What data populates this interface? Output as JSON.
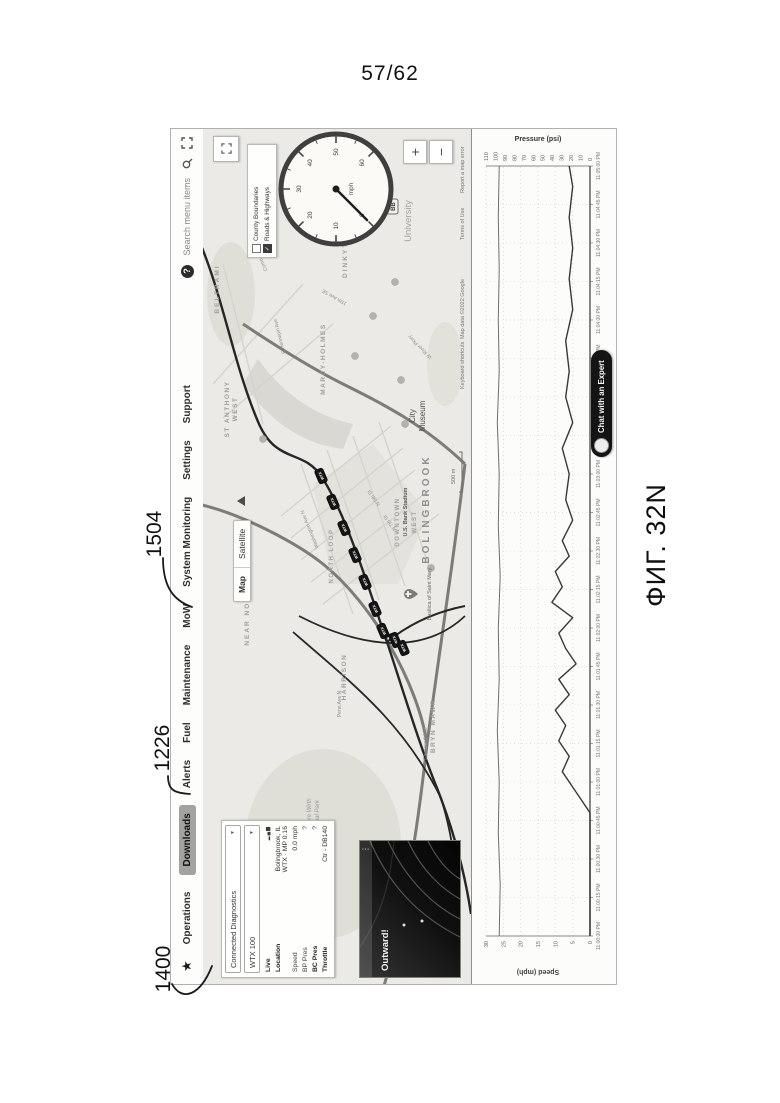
{
  "page": {
    "sheet_number": "57/62",
    "figure_label": "ФИГ. 32N",
    "refs": [
      {
        "id": "1400"
      },
      {
        "id": "1226"
      },
      {
        "id": "1504"
      }
    ]
  },
  "nav": {
    "star_icon": "★",
    "items": [
      {
        "label": "Operations",
        "active": false
      },
      {
        "label": "Downloads",
        "active": true
      },
      {
        "label": "Alerts",
        "active": false
      },
      {
        "label": "Fuel",
        "active": false
      },
      {
        "label": "Maintenance",
        "active": false
      },
      {
        "label": "MoW",
        "active": false
      },
      {
        "label": "System Monitoring",
        "active": false
      },
      {
        "label": "Settings",
        "active": false
      },
      {
        "label": "Support",
        "active": false
      }
    ],
    "help_label": "?",
    "search_placeholder": "Search menu items"
  },
  "sidebar": {
    "fleet_select": "Connected Diagnostics",
    "unit_select": "WTX 100",
    "live_label": "Live",
    "location_label": "Location",
    "location_value_line1": "Bolingbrook, IL",
    "location_value_line2": "WTX · MP 0.16",
    "rows": [
      {
        "label": "Speed",
        "value": "0.0 mph",
        "bold": false
      },
      {
        "label": "BP Pres",
        "value": "?",
        "bold": false
      },
      {
        "label": "BC Pres",
        "value": "?",
        "bold": true
      },
      {
        "label": "Throttle",
        "value": "Ctr - DB140",
        "bold": true
      }
    ]
  },
  "video": {
    "title": "Outward!",
    "menu_icon": "⋮"
  },
  "map": {
    "toggle": {
      "map_label": "Map",
      "satellite_label": "Satellite"
    },
    "layers": [
      {
        "label": "County Boundaries",
        "checked": false
      },
      {
        "label": "Roads & Highways",
        "checked": true
      }
    ],
    "gauge": {
      "unit": "mph",
      "tick_labels": [
        "0",
        "10",
        "20",
        "30",
        "40",
        "50",
        "60"
      ],
      "value_mph": 0
    },
    "controls": {
      "zoom_in": "+",
      "zoom_out": "−"
    },
    "scale_label": "500 m",
    "bb_label": "BB",
    "attribution": [
      {
        "text": "Keyboard shortcuts",
        "x": 595
      },
      {
        "text": "Map data ©2022 Google",
        "x": 645
      },
      {
        "text": "Terms of Use",
        "x": 744
      },
      {
        "text": "Report a map error",
        "x": 791
      }
    ],
    "place_labels": [
      {
        "lines": [
          "BELTRAMI"
        ],
        "x": 695,
        "y": 16,
        "s": 6.5,
        "ls": 2,
        "c": "#9e9e9e",
        "w": 600
      },
      {
        "lines": [
          "ST ANTHONY",
          "WEST"
        ],
        "x": 575,
        "y": 26,
        "s": 6.5,
        "ls": 1.5,
        "c": "#9e9e9e",
        "w": 600,
        "lh": 8
      },
      {
        "lines": [
          "NEAR NORTH"
        ],
        "x": 370,
        "y": 46,
        "s": 6.5,
        "ls": 2,
        "c": "#9e9e9e",
        "w": 600
      },
      {
        "lines": [
          "MARCY-HOLMES"
        ],
        "x": 625,
        "y": 122,
        "s": 6.5,
        "ls": 1.5,
        "c": "#9e9e9e",
        "w": 600
      },
      {
        "lines": [
          "DINKYTOWN"
        ],
        "x": 735,
        "y": 144,
        "s": 6.5,
        "ls": 2,
        "c": "#9e9e9e",
        "w": 600
      },
      {
        "lines": [
          "NORTH LOOP"
        ],
        "x": 428,
        "y": 130,
        "s": 6,
        "ls": 1.5,
        "c": "#a2a2a2",
        "w": 600
      },
      {
        "lines": [
          "HARRISON"
        ],
        "x": 307,
        "y": 143,
        "s": 6.5,
        "ls": 1.5,
        "c": "#9e9e9e",
        "w": 600
      },
      {
        "lines": [
          "BRYN MAWR"
        ],
        "x": 258,
        "y": 232,
        "s": 6.5,
        "ls": 1.5,
        "c": "#9e9e9e",
        "w": 600
      },
      {
        "lines": [
          "DOWNTOWN"
        ],
        "x": 462,
        "y": 196,
        "s": 6,
        "ls": 1.5,
        "c": "#a0a0a0",
        "w": 600
      },
      {
        "lines": [
          "U.S. Bank Stadium"
        ],
        "x": 472,
        "y": 204,
        "s": 5.5,
        "c": "#5a5a5a",
        "w": 600
      },
      {
        "lines": [
          "WEST"
        ],
        "x": 462,
        "y": 213,
        "s": 6,
        "ls": 1.5,
        "c": "#a0a0a0",
        "w": 600
      },
      {
        "lines": [
          "BOLINGBROOK"
        ],
        "x": 475,
        "y": 226,
        "s": 10,
        "ls": 3,
        "c": "#8f8f8f",
        "w": 700
      },
      {
        "lines": [
          "City",
          "Museum"
        ],
        "x": 568,
        "y": 212,
        "s": 8,
        "c": "#4c4c4c",
        "w": 400,
        "lh": 10
      },
      {
        "lines": [
          "Basilica of Saint Mary"
        ],
        "x": 390,
        "y": 228,
        "s": 5.5,
        "c": "#6a6a6a",
        "w": 400
      },
      {
        "lines": [
          "University"
        ],
        "x": 763,
        "y": 208,
        "s": 9.5,
        "c": "#a3a3a3",
        "w": 400
      },
      {
        "lines": [
          "Theodore Wirth",
          "Regional Park"
        ],
        "x": 165,
        "y": 108,
        "s": 6,
        "c": "#9a9a9a",
        "w": 400,
        "italic": true,
        "lh": 8
      },
      {
        "lines": [
          "Washington Ave N"
        ],
        "x": 455,
        "y": 108,
        "s": 5,
        "c": "#8d8d8d",
        "rot": -22
      },
      {
        "lines": [
          "N 5th St"
        ],
        "x": 487,
        "y": 172,
        "s": 5,
        "c": "#8d8d8d",
        "rot": -35
      },
      {
        "lines": [
          "N 7th St"
        ],
        "x": 462,
        "y": 188,
        "s": 5,
        "c": "#8d8d8d",
        "rot": -35
      },
      {
        "lines": [
          "Penn Ave N"
        ],
        "x": 280,
        "y": 138,
        "s": 5,
        "c": "#8d8d8d"
      },
      {
        "lines": [
          "15th Ave SE"
        ],
        "x": 688,
        "y": 132,
        "s": 5,
        "c": "#8d8d8d",
        "rot": -60
      },
      {
        "lines": [
          "E Hennepin Ave"
        ],
        "x": 648,
        "y": 78,
        "s": 5,
        "c": "#8d8d8d",
        "rot": -14
      },
      {
        "lines": [
          "Como Ave SE"
        ],
        "x": 728,
        "y": 58,
        "s": 5,
        "c": "#8d8d8d",
        "rot": -24
      },
      {
        "lines": [
          "W River Pkwy"
        ],
        "x": 638,
        "y": 218,
        "s": 5,
        "c": "#8d8d8d",
        "rot": -45
      },
      {
        "lines": [
          "Glenwood Ave"
        ],
        "x": 240,
        "y": 224,
        "s": 5,
        "c": "#8d8d8d"
      }
    ],
    "train_markers": {
      "label": "WTX",
      "positions": [
        [
          508,
          118
        ],
        [
          482,
          130
        ],
        [
          456,
          141
        ],
        [
          429,
          152
        ],
        [
          402,
          162
        ],
        [
          375,
          172
        ],
        [
          353,
          180
        ],
        [
          344,
          192
        ],
        [
          336,
          200
        ]
      ]
    },
    "poi_dots": [
      [
        628,
        152
      ],
      [
        604,
        198
      ],
      [
        702,
        192
      ],
      [
        560,
        202
      ],
      [
        416,
        228
      ],
      [
        668,
        170
      ],
      [
        545,
        60
      ]
    ],
    "church_pin": {
      "x": 390,
      "y": 206
    }
  },
  "chat": {
    "label": "Chat with an Expert"
  },
  "chart_data": {
    "type": "line",
    "title": "",
    "x_axis": {
      "label": "",
      "tick_labels": [
        "11:00:00 PM",
        "11:00:15 PM",
        "11:00:30 PM",
        "11:00:45 PM",
        "11:01:00 PM",
        "11:01:15 PM",
        "11:01:30 PM",
        "11:01:45 PM",
        "11:02:00 PM",
        "11:02:15 PM",
        "11:02:30 PM",
        "11:02:45 PM",
        "11:03:00 PM",
        "11:03:15 PM",
        "11:03:30 PM",
        "11:03:45 PM",
        "11:04:00 PM",
        "11:04:15 PM",
        "11:04:30 PM",
        "11:04:45 PM",
        "11:05:00 PM"
      ],
      "t_max_seconds": 300
    },
    "y_left": {
      "label": "Speed (mph)",
      "range": [
        0,
        30
      ],
      "ticks": [
        0,
        5,
        10,
        15,
        20,
        25,
        30
      ]
    },
    "y_right": {
      "label": "Pressure (psi)",
      "range": [
        0,
        110
      ],
      "ticks": [
        0,
        10,
        20,
        30,
        40,
        50,
        60,
        70,
        80,
        90,
        100,
        110
      ]
    },
    "grid": true,
    "legend": "none",
    "series": [
      {
        "name": "Speed",
        "axis": "left",
        "color": "#383838",
        "points": [
          [
            0,
            0
          ],
          [
            10,
            0
          ],
          [
            20,
            0
          ],
          [
            30,
            0
          ],
          [
            40,
            0
          ],
          [
            48,
            0
          ],
          [
            52,
            2
          ],
          [
            58,
            5
          ],
          [
            64,
            8
          ],
          [
            70,
            6
          ],
          [
            76,
            9
          ],
          [
            82,
            7
          ],
          [
            88,
            10
          ],
          [
            94,
            6
          ],
          [
            100,
            9
          ],
          [
            106,
            4
          ],
          [
            112,
            7
          ],
          [
            118,
            9
          ],
          [
            124,
            5
          ],
          [
            130,
            11
          ],
          [
            136,
            8
          ],
          [
            142,
            10
          ],
          [
            148,
            6
          ],
          [
            154,
            8
          ],
          [
            162,
            5
          ],
          [
            170,
            7
          ],
          [
            180,
            6
          ],
          [
            190,
            8
          ],
          [
            200,
            5
          ],
          [
            210,
            7
          ],
          [
            220,
            6
          ],
          [
            232,
            7
          ],
          [
            244,
            5
          ],
          [
            256,
            6
          ],
          [
            268,
            5
          ],
          [
            280,
            6
          ],
          [
            292,
            5
          ],
          [
            300,
            6
          ]
        ]
      },
      {
        "name": "Pressure",
        "axis": "right",
        "color": "#6e6e6e",
        "points": [
          [
            0,
            96
          ],
          [
            20,
            95
          ],
          [
            40,
            97
          ],
          [
            60,
            96
          ],
          [
            80,
            98
          ],
          [
            100,
            96
          ],
          [
            120,
            97
          ],
          [
            140,
            95
          ],
          [
            160,
            97
          ],
          [
            180,
            96
          ],
          [
            200,
            98
          ],
          [
            220,
            96
          ],
          [
            240,
            97
          ],
          [
            260,
            96
          ],
          [
            280,
            97
          ],
          [
            300,
            96
          ]
        ]
      }
    ]
  }
}
